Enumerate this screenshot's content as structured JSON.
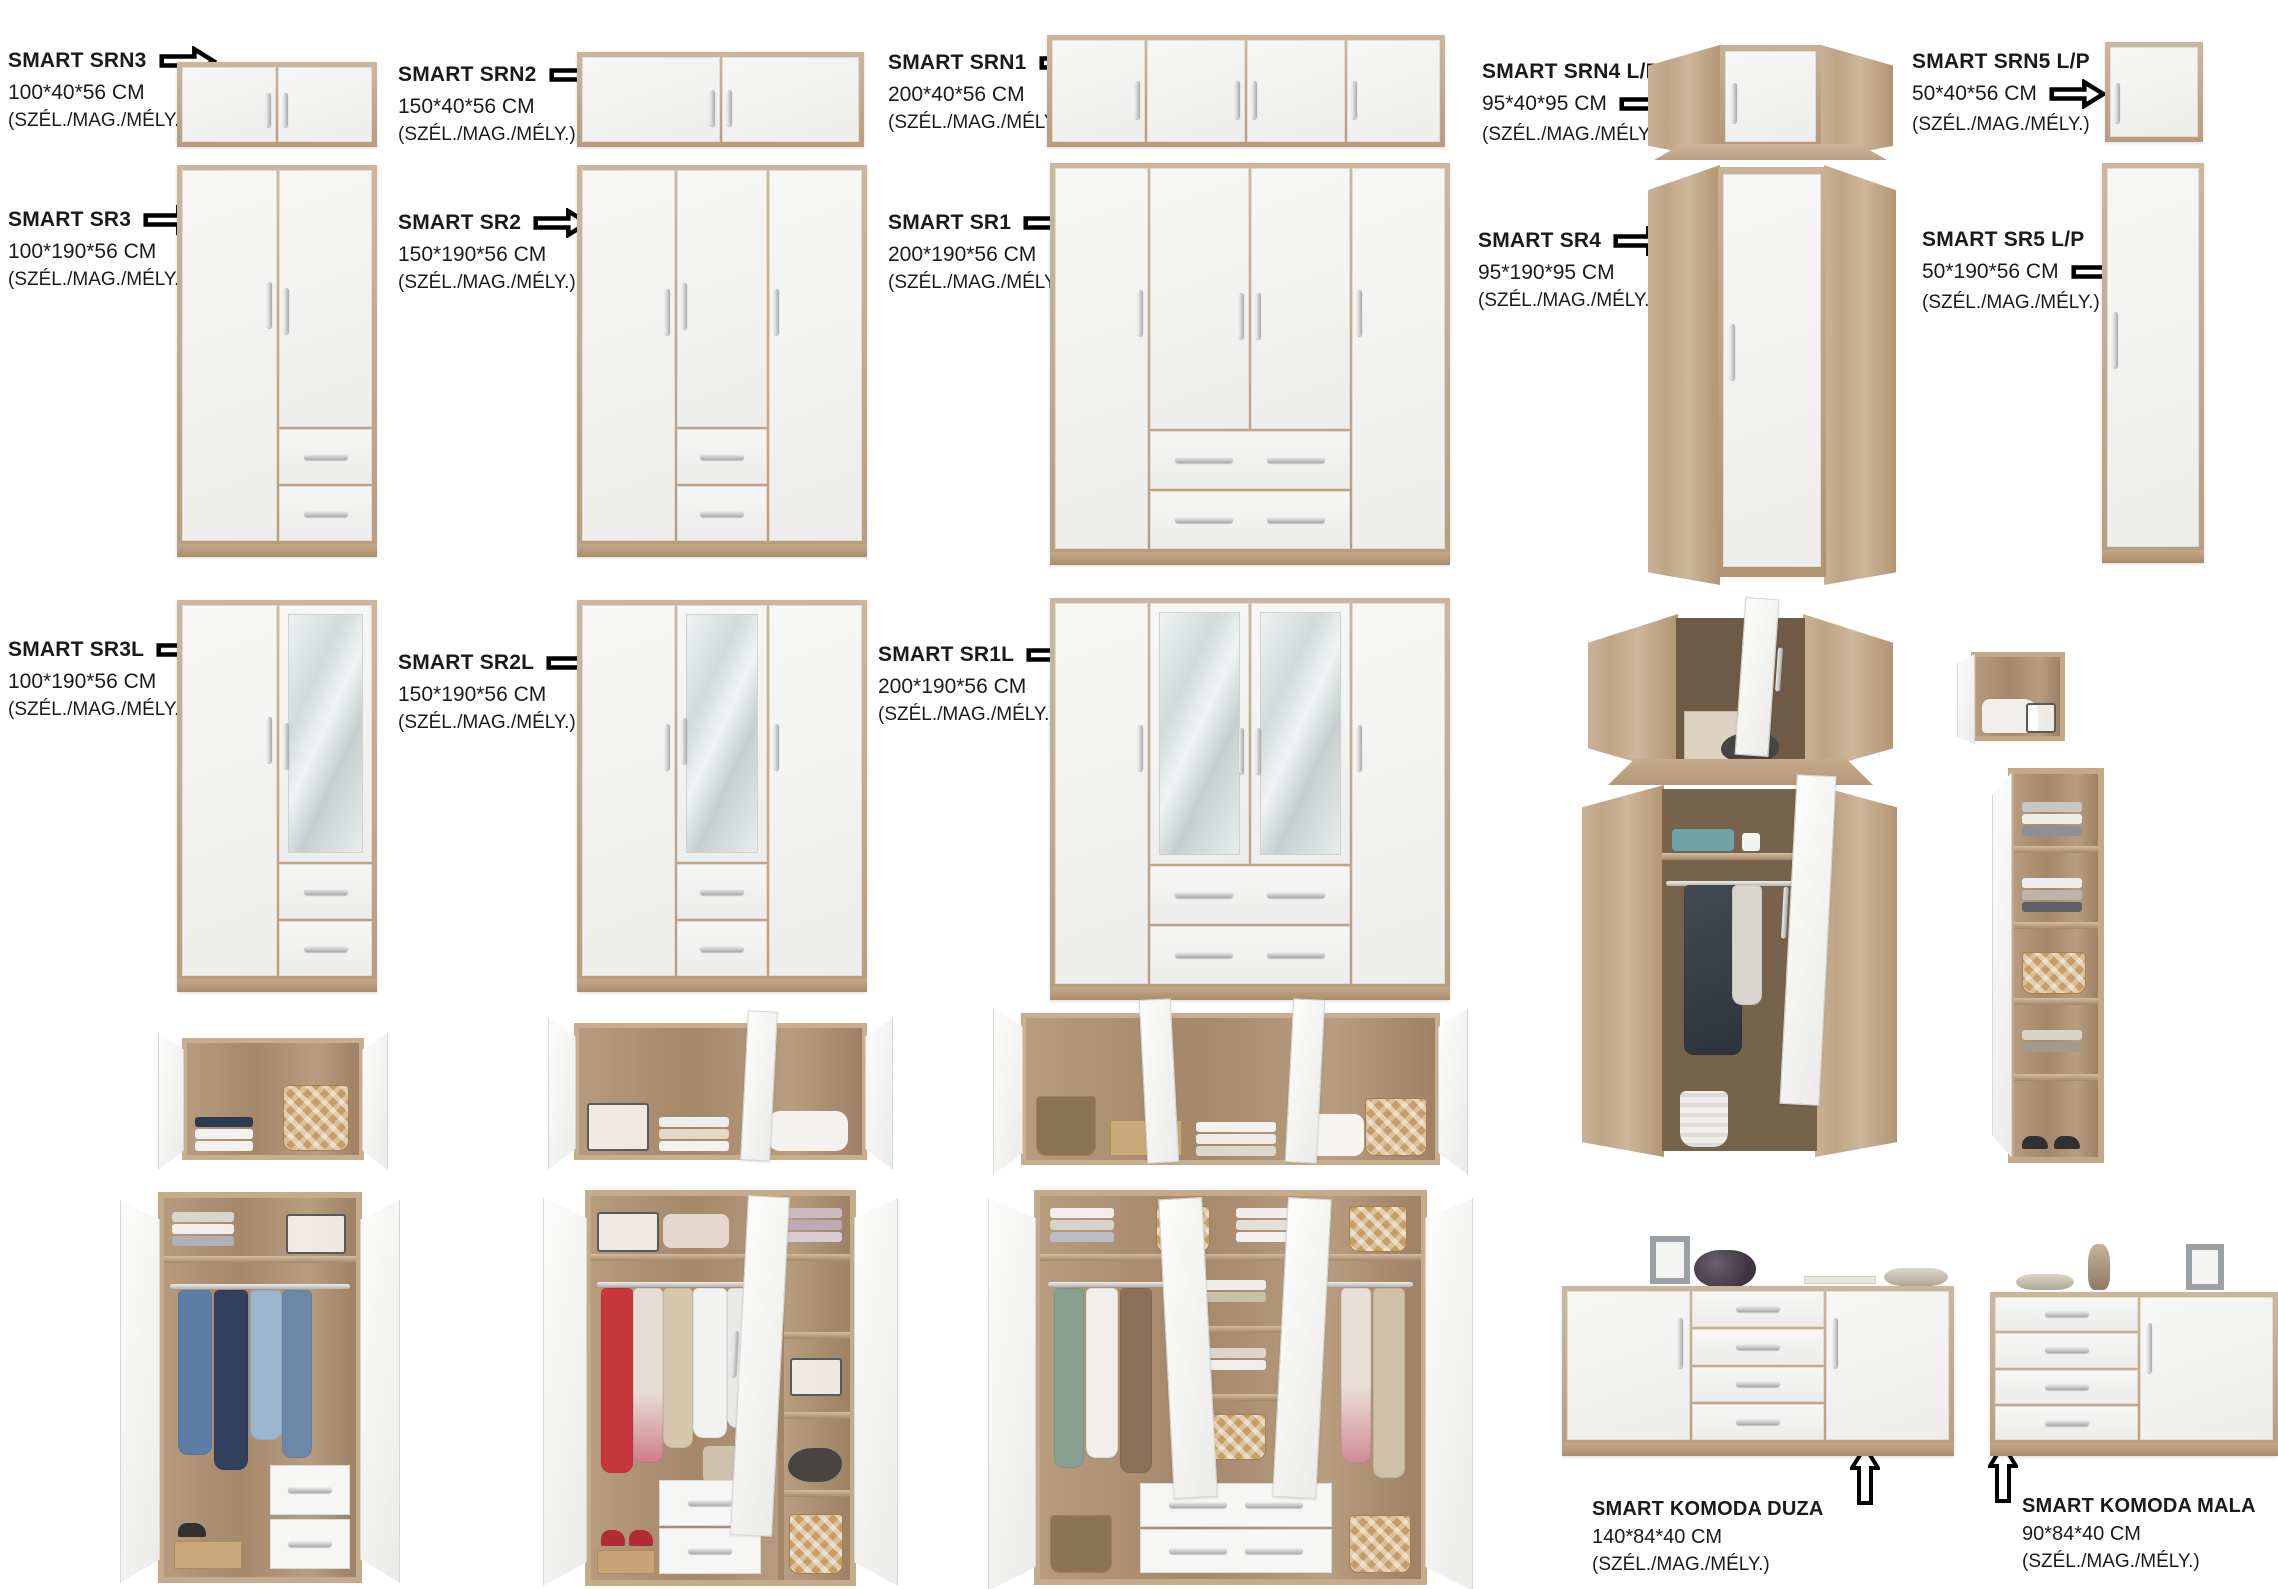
{
  "page": {
    "background": "#ffffff",
    "language": "hu"
  },
  "colors": {
    "wood": "#c8b094",
    "wood_dark": "#a98e6f",
    "door_white": "#f4f4f2",
    "handle_silver": "#aaabad",
    "mirror": "#d7dede",
    "text": "#1a1a1a",
    "interior_wood": "#ab8e70"
  },
  "icons": {
    "arrow_right": "block-arrow-right",
    "arrow_up": "block-arrow-up"
  },
  "products": {
    "srn3": {
      "name": "SMART SRN3",
      "dims": "100*40*56 CM",
      "note": "(SZÉL./MAG./MÉLY.)"
    },
    "srn2": {
      "name": "SMART SRN2",
      "dims": "150*40*56 CM",
      "note": "(SZÉL./MAG./MÉLY.)"
    },
    "srn1": {
      "name": "SMART SRN1",
      "dims": "200*40*56 CM",
      "note": "(SZÉL./MAG./MÉLY.)"
    },
    "srn4": {
      "name": "SMART SRN4  L/P",
      "dims": "95*40*95 CM",
      "note": "(SZÉL./MAG./MÉLY.)"
    },
    "srn5": {
      "name": "SMART SRN5  L/P",
      "dims": "50*40*56 CM",
      "note": "(SZÉL./MAG./MÉLY.)"
    },
    "sr3": {
      "name": "SMART SR3",
      "dims": "100*190*56 CM",
      "note": "(SZÉL./MAG./MÉLY.)"
    },
    "sr2": {
      "name": "SMART SR2",
      "dims": "150*190*56 CM",
      "note": "(SZÉL./MAG./MÉLY.)"
    },
    "sr1": {
      "name": "SMART SR1",
      "dims": "200*190*56 CM",
      "note": "(SZÉL./MAG./MÉLY.)"
    },
    "sr4": {
      "name": "SMART SR4",
      "dims": "95*190*95 CM",
      "note": "(SZÉL./MAG./MÉLY.)"
    },
    "sr5": {
      "name": "SMART SR5  L/P",
      "dims": "50*190*56 CM",
      "note": "(SZÉL./MAG./MÉLY.)"
    },
    "sr3l": {
      "name": "SMART SR3L",
      "dims": "100*190*56 CM",
      "note": "(SZÉL./MAG./MÉLY.)"
    },
    "sr2l": {
      "name": "SMART SR2L",
      "dims": "150*190*56 CM",
      "note": "(SZÉL./MAG./MÉLY.)"
    },
    "sr1l": {
      "name": "SMART SR1L",
      "dims": "200*190*56 CM",
      "note": "(SZÉL./MAG./MÉLY.)"
    },
    "komoda_duza": {
      "name": "SMART KOMODA DUZA",
      "dims": "140*84*40 CM",
      "note": "(SZÉL./MAG./MÉLY.)"
    },
    "komoda_mala": {
      "name": "SMART KOMODA MALA",
      "dims": "90*84*40 CM",
      "note": "(SZÉL./MAG./MÉLY.)"
    }
  }
}
